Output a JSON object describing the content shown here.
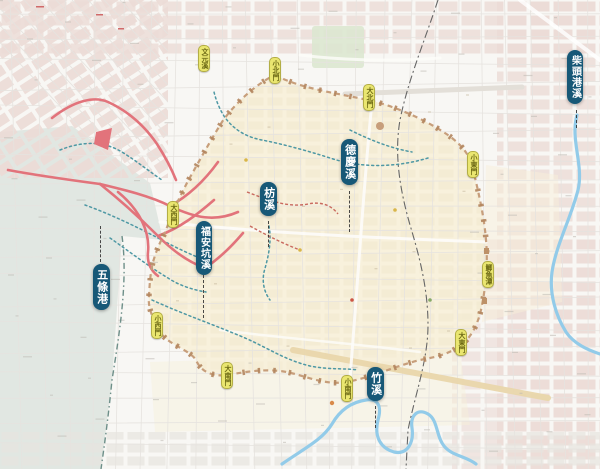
{
  "map": {
    "region_description": "historic waterways map of Tainan city",
    "stream_labels": [
      {
        "id": "wutiaogang",
        "text": "五條港",
        "x": 93,
        "y": 264,
        "leader": {
          "x": 100,
          "y1": 226,
          "y2": 262
        }
      },
      {
        "id": "fuankengxi",
        "text": "福安坑溪",
        "x": 196,
        "y": 221,
        "leader": {
          "x": 203,
          "y1": 275,
          "y2": 318
        }
      },
      {
        "id": "fangxi",
        "text": "枋溪",
        "x": 260,
        "y": 182,
        "leader": {
          "x": 268,
          "y1": 221,
          "y2": 247
        }
      },
      {
        "id": "deqingxi",
        "text": "德慶溪",
        "x": 341,
        "y": 139,
        "leader": {
          "x": 349,
          "y1": 191,
          "y2": 232
        }
      },
      {
        "id": "zhuxi",
        "text": "竹溪",
        "x": 367,
        "y": 367,
        "leader": {
          "x": 375,
          "y1": 406,
          "y2": 428
        }
      },
      {
        "id": "chaitougangxi",
        "text": "柴頭港溪",
        "x": 567,
        "y": 50,
        "leader": {
          "x": 576,
          "y1": 110,
          "y2": 128
        }
      }
    ],
    "gate_labels": [
      {
        "id": "wenyuanxi",
        "text": "文元溪",
        "x": 198,
        "y": 45
      },
      {
        "id": "xiaobeimen",
        "text": "小北門",
        "x": 269,
        "y": 57
      },
      {
        "id": "dabeimen",
        "text": "大北門",
        "x": 363,
        "y": 84
      },
      {
        "id": "xiaodongmen",
        "text": "小東門",
        "x": 467,
        "y": 151
      },
      {
        "id": "jiyutan",
        "text": "鯽魚潭",
        "x": 482,
        "y": 261
      },
      {
        "id": "dadongmen",
        "text": "大東門",
        "x": 455,
        "y": 329
      },
      {
        "id": "xiaonanmen",
        "text": "小南門",
        "x": 341,
        "y": 375
      },
      {
        "id": "dananmen",
        "text": "大南門",
        "x": 221,
        "y": 362
      },
      {
        "id": "xiaoximen",
        "text": "小西門",
        "x": 151,
        "y": 312
      },
      {
        "id": "daximen",
        "text": "大西門",
        "x": 167,
        "y": 201
      }
    ],
    "colors": {
      "stream_label_bg": "#175877",
      "stream_label_text": "#ffffff",
      "gate_bg": "#eae670",
      "gate_text": "#6d6a15",
      "city_wall": "#c79e7b",
      "canal_red": "#e2737b",
      "old_stream_teal": "#4e98a4",
      "river_blue": "#92cbe9",
      "old_shore_shade": "#c9d7d0"
    }
  }
}
